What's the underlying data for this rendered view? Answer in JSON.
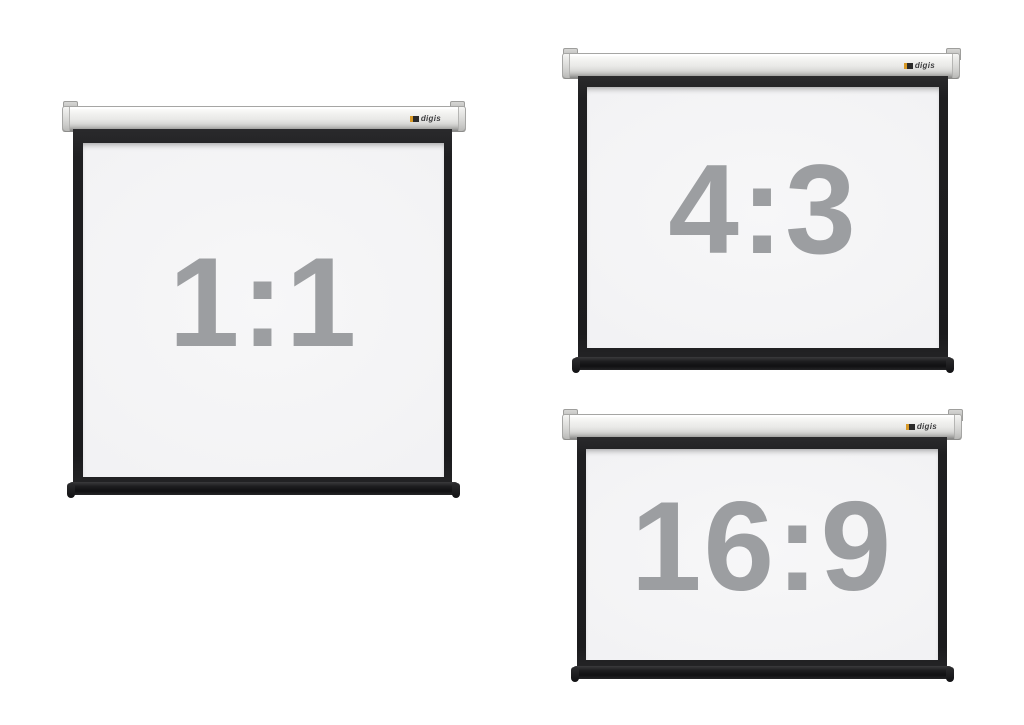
{
  "page": {
    "background_color": "#ffffff"
  },
  "brand": {
    "logo_text": "digis",
    "logo_accent_color": "#d89a28",
    "logo_text_color": "#3b3b3d"
  },
  "colors": {
    "case": "#e3e3e1",
    "frame_black": "#1f1f21",
    "surface_white": "#f2f2f4",
    "weight_bar_black": "#151517",
    "ratio_text_gray": "#9c9ea1"
  },
  "screens": [
    {
      "id": "screen-1-1",
      "ratio_label": "1:1"
    },
    {
      "id": "screen-4-3",
      "ratio_label": "4:3"
    },
    {
      "id": "screen-16-9",
      "ratio_label": "16:9"
    }
  ]
}
